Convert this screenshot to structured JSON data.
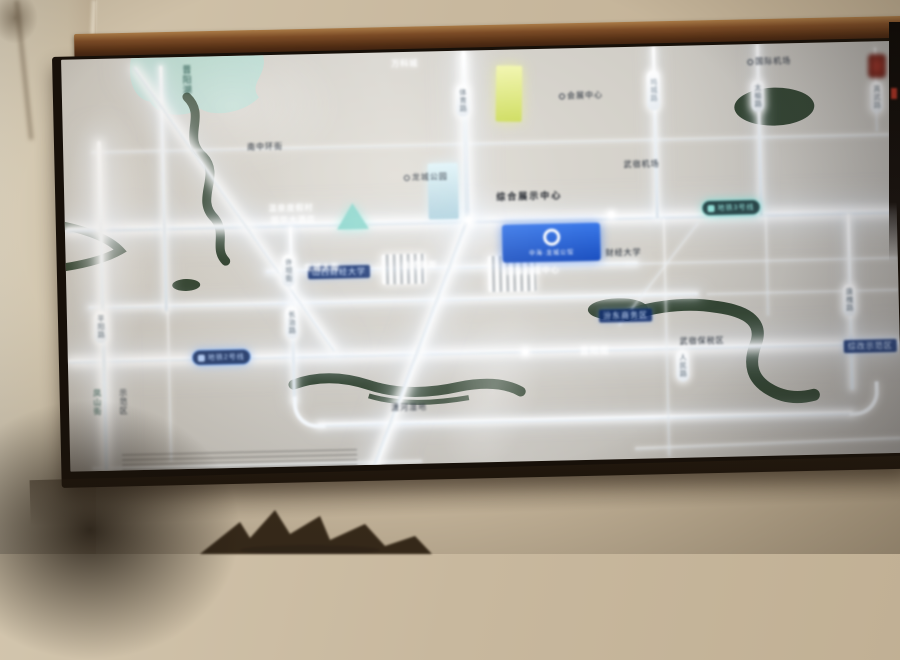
{
  "scene": {
    "type": "photo-of-illuminated-district-map-lightbox",
    "colors": {
      "wall": "#c8b89e",
      "frame_wood": "#6b4124",
      "panel_base": "#d1cec7",
      "road_glow": "#ffffff",
      "water_green": "#263a26",
      "lake_blue": "#b9dcd3",
      "billboard_blue": "#2a63d4",
      "metro_teal": "#9df0e7",
      "metro_blue": "#bdd7ff"
    }
  },
  "billboard": {
    "name": "中海·龙城公馆"
  },
  "metro": {
    "line2_label": "地铁2号线",
    "line3_label": "地铁3号线"
  },
  "lake_label": "晋阳湖",
  "pills": {
    "p1": "体育路",
    "p2": "坞城路",
    "p3": "太榆路",
    "p4": "真武路",
    "p5": "平阳路",
    "p6": "长治路",
    "p7": "唐槐路",
    "p8": "人民路",
    "p9": "许坦街"
  },
  "dark_labels": {
    "d1": "南中环街",
    "d2": "龙城公园",
    "d3": "综合展示中心",
    "d4": "会展中心",
    "d5": "武宿机场",
    "d6": "国际机场",
    "d8": "财经大学",
    "d9": "武宿保税区",
    "d10": "潇河湿地",
    "d11": "示范区",
    "d12": "凤山街"
  },
  "blue_labels": {
    "b1": "山西财经大学",
    "b2": "汾东商务区",
    "b3": "综改示范区"
  },
  "glow_labels": {
    "g1": "温泉度假村",
    "g2": "丽华大酒店",
    "g3": "龙城大街",
    "g4": "奥特莱斯",
    "g5": "国际会展中心",
    "g6": "晋阳街",
    "g7": "万科城"
  }
}
